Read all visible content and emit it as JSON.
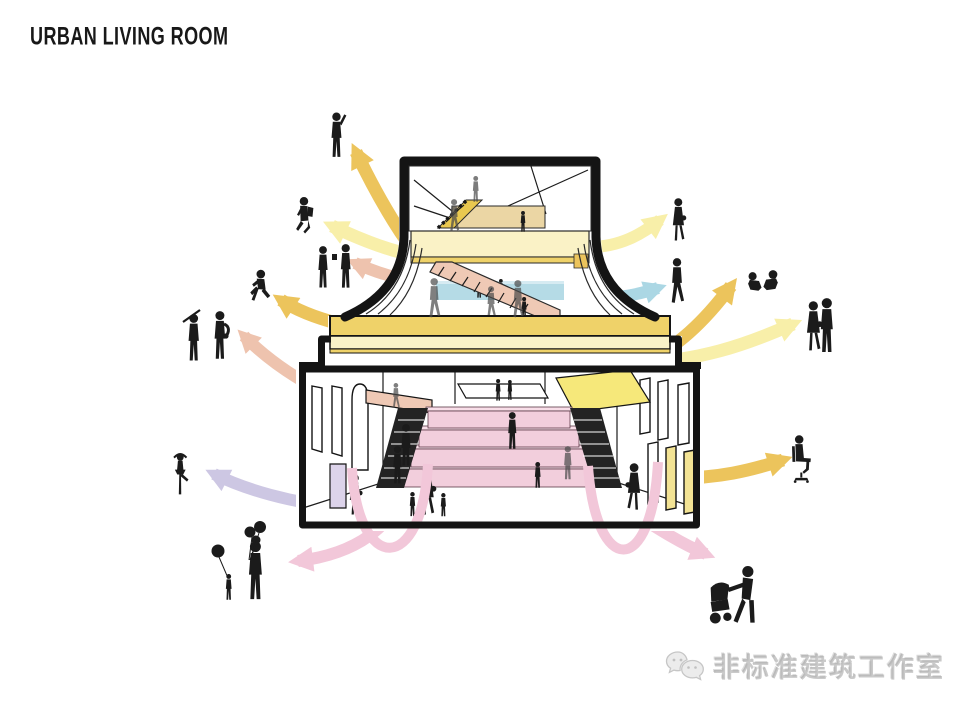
{
  "header": {
    "title": "URBAN LIVING ROOM"
  },
  "watermark": {
    "text": "非标准建筑工作室",
    "icon": "wechat-bubbles-icon"
  },
  "colors": {
    "ink": "#141414",
    "silhouette": "#1b1b1b",
    "gold": "#ECC45C",
    "light_yellow": "#F8EFA9",
    "salmon": "#EEC3AE",
    "blue": "#ABD7E4",
    "lavender": "#CDC7E3",
    "pink": "#F2C7D9",
    "slab_gold": "#EFD269",
    "slab_pale": "#FAF3C8",
    "stair_yellow": "#E9C84F",
    "tan": "#EBD6A4",
    "mezzanine_pale": "#FAF2C6",
    "blue_floor": "#B5DBE6",
    "pink_stair": "#EFC9B5",
    "tier_pink": "#F2CEDC",
    "tier_pink_top": "#F8DEE8",
    "ramp_yellow": "#F6E87A",
    "window_yellow": "#F3E394",
    "door_lavender": "#DCD3EA",
    "dark_stair": "#232323"
  },
  "diagram": {
    "building_levels": [
      "attic-workshop-with-yellow-stair",
      "pale-yellow-mezzanine",
      "pink-grand-stair-and-blue-floor",
      "golden-platform-slab",
      "hall-with-pink-amphitheater-tiers"
    ],
    "flows": [
      {
        "id": "out-upper-left-1",
        "color_key": "gold",
        "direction": "up-left",
        "audience": "person-waving"
      },
      {
        "id": "out-upper-left-2",
        "color_key": "light_yellow",
        "direction": "left",
        "audience": "person-jumping-with-backpack"
      },
      {
        "id": "out-left-3",
        "color_key": "salmon",
        "direction": "left",
        "audience": "couple-talking"
      },
      {
        "id": "out-left-4",
        "color_key": "gold",
        "direction": "up-left",
        "audience": "child-running"
      },
      {
        "id": "out-left-5",
        "color_key": "salmon",
        "direction": "up-left",
        "audience": "street-musicians-duo"
      },
      {
        "id": "out-left-6",
        "color_key": "lavender",
        "direction": "left",
        "audience": "ballet-dancer"
      },
      {
        "id": "out-lower-left-7",
        "color_key": "pink",
        "direction": "down-left",
        "audience": "mother-and-child-with-balloons"
      },
      {
        "id": "out-right-1",
        "color_key": "light_yellow",
        "direction": "right",
        "audience": "woman-walking-with-bag"
      },
      {
        "id": "out-right-2",
        "color_key": "blue",
        "direction": "right",
        "audience": "man-walking"
      },
      {
        "id": "out-right-3",
        "color_key": "gold",
        "direction": "up-right",
        "audience": "children-playing"
      },
      {
        "id": "out-right-4",
        "color_key": "light_yellow",
        "direction": "right",
        "audience": "couple-standing"
      },
      {
        "id": "out-right-5",
        "color_key": "gold",
        "direction": "right",
        "audience": "person-sitting-on-chair"
      },
      {
        "id": "out-lower-right-6",
        "color_key": "pink",
        "direction": "down-right",
        "audience": "parent-pushing-stroller"
      }
    ],
    "people_outside_left": [
      "person-waving",
      "person-jumping-with-backpack",
      "couple-talking",
      "child-running",
      "street-musicians-duo",
      "ballet-dancer",
      "mother-and-child-with-balloons"
    ],
    "people_outside_right": [
      "woman-walking-with-bag",
      "man-walking",
      "children-playing",
      "couple-standing",
      "person-sitting-on-chair",
      "parent-pushing-stroller"
    ]
  }
}
